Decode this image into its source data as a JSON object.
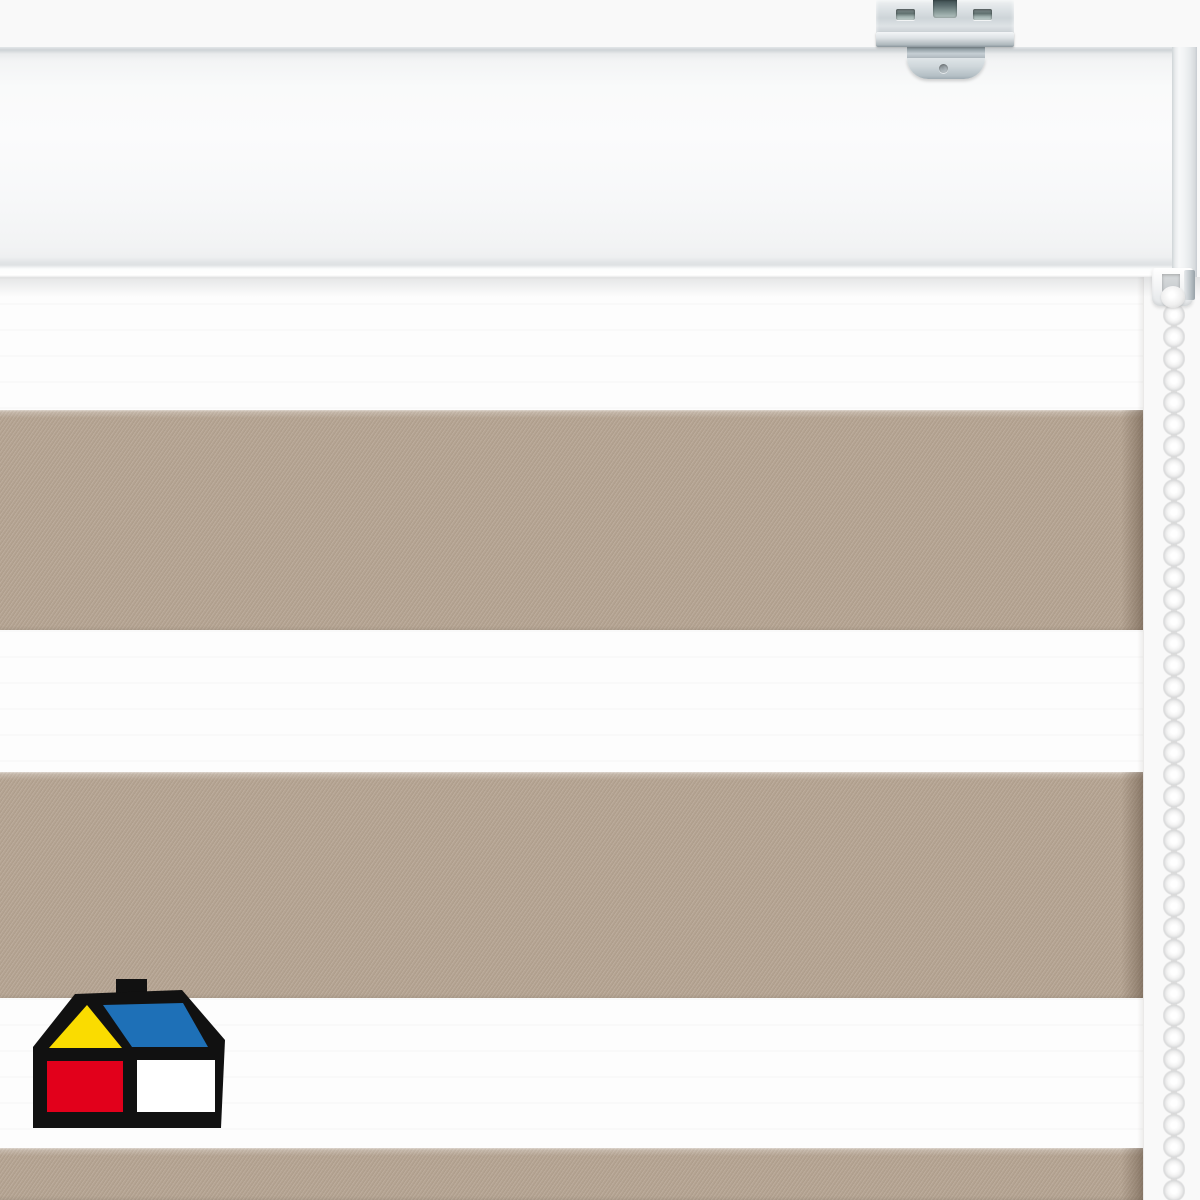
{
  "scene": {
    "description": "Product photograph of a day-night (zebra) dual roller blind shown from the front: white headrail with galvanized steel mounting bracket on top, fabric with alternating sheer white and opaque beige horizontal stripes, white bead control chain hanging on the right side, brand house logo in the lower-left corner.",
    "width_px": 1200,
    "height_px": 1200
  },
  "colors": {
    "background": "#f9f9f9",
    "fabric_beige": "#b4a391",
    "fabric_white": "#fdfdfd",
    "headrail_white": "#f6f7f8",
    "chain_white": "#ececec",
    "bracket_metal": "#cdd4d8",
    "logo_outline": "#111111",
    "logo_yellow": "#fadc00",
    "logo_blue": "#1e70b7",
    "logo_red": "#e2001b",
    "logo_white": "#ffffff"
  },
  "blind": {
    "headrail": {
      "top": 47,
      "height": 230,
      "face_width": 1172,
      "endcap_width": 25
    },
    "bracket": {
      "finish": "galvanized-steel",
      "left": 876,
      "width": 138,
      "has_screw_hole": true
    },
    "chain": {
      "side": "right",
      "bead_pitch_px": 22,
      "center_x": 1174,
      "starts_y": 286
    },
    "fabric": {
      "right_edge_x": 1143,
      "stripes": [
        {
          "type": "white",
          "top": 277,
          "height": 133
        },
        {
          "type": "beige",
          "top": 410,
          "height": 220
        },
        {
          "type": "white",
          "top": 630,
          "height": 142
        },
        {
          "type": "beige",
          "top": 772,
          "height": 226
        },
        {
          "type": "white",
          "top": 998,
          "height": 150
        },
        {
          "type": "beige",
          "top": 1148,
          "height": 52
        }
      ]
    }
  },
  "logo": {
    "name": "sodimac-homecenter-house-logo",
    "position": {
      "x": 31,
      "y": 977,
      "width": 196,
      "height": 152
    },
    "parts": [
      "black-outline-house",
      "black-chimney",
      "yellow-gable-triangle",
      "blue-roof-panel",
      "red-wall-square",
      "white-wall-square"
    ]
  }
}
